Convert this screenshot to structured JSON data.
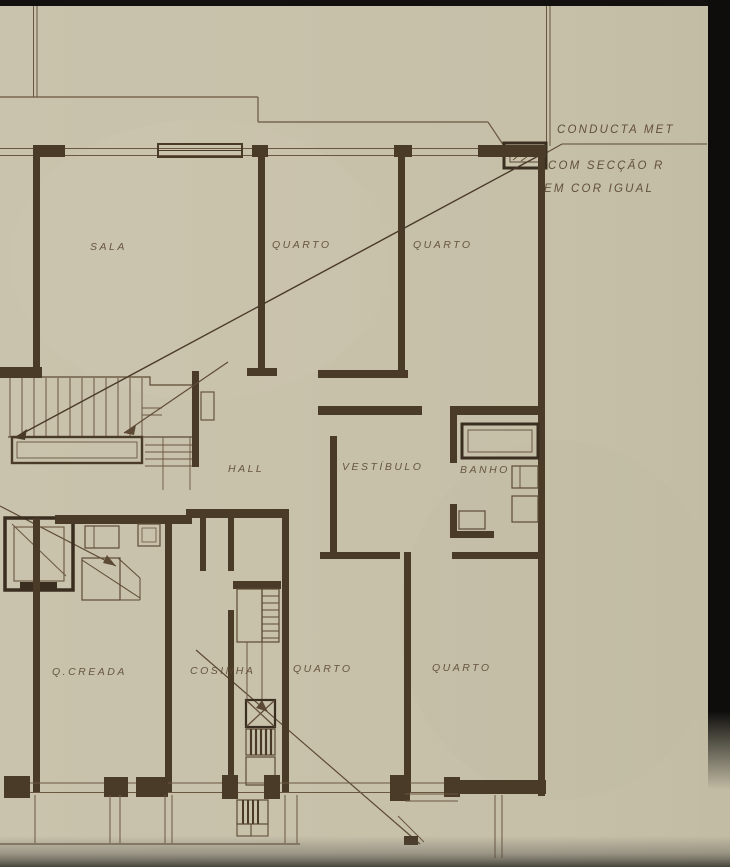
{
  "document_type": "scanned architectural floor plan",
  "rooms": {
    "sala": "SALA",
    "quarto_top_1": "QUARTO",
    "quarto_top_2": "QUARTO",
    "hall": "HALL",
    "vestibulo": "VESTÍBULO",
    "banho": "BANHO",
    "q_creada": "Q.CREADA",
    "cosinha": "COSINHA",
    "quarto_bottom_1": "QUARTO",
    "quarto_bottom_2": "QUARTO"
  },
  "annotation": {
    "line1": "CONDUCTA MET",
    "line2": "COM SECÇÃO R",
    "line3": "EM COR IGUAL"
  },
  "colors": {
    "paper": "#c8c2ab",
    "ink": "#5d4a34",
    "ink_dark": "#3a2e20",
    "wall_fill": "#4a3a28",
    "scan_black": "#121110"
  }
}
